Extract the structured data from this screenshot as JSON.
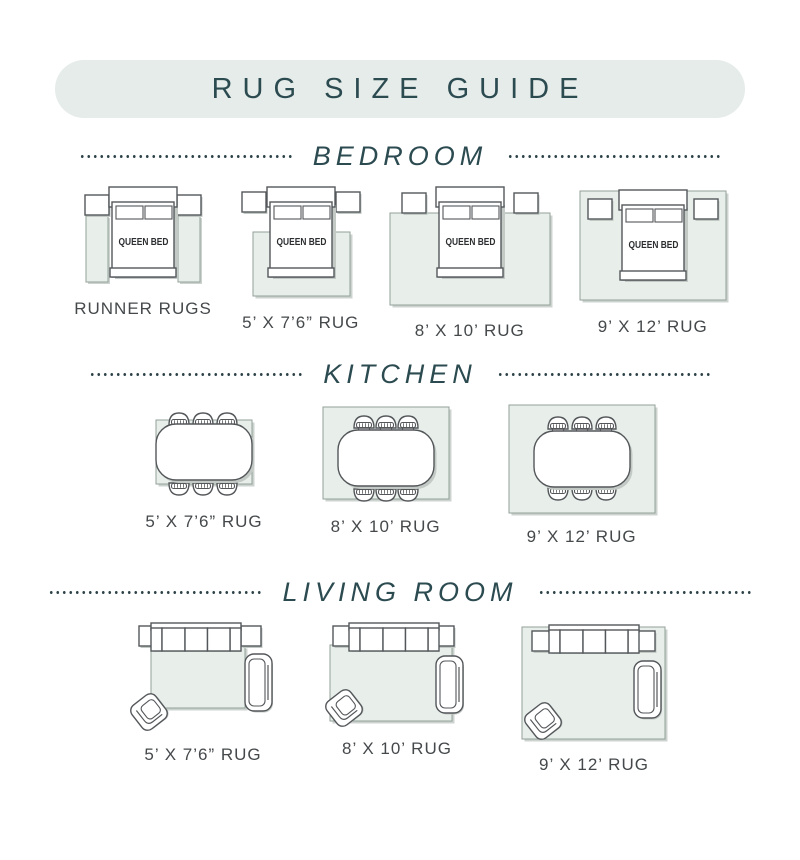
{
  "title": "RUG SIZE GUIDE",
  "bed_label": "QUEEN BED",
  "sections": [
    {
      "heading": "BEDROOM",
      "items": [
        {
          "label": "RUNNER RUGS"
        },
        {
          "label": "5’ X 7’6” RUG"
        },
        {
          "label": "8’ X 10’ RUG"
        },
        {
          "label": "9’ X 12’ RUG"
        }
      ]
    },
    {
      "heading": "KITCHEN",
      "items": [
        {
          "label": "5’ X 7’6” RUG"
        },
        {
          "label": "8’ X 10’ RUG"
        },
        {
          "label": "9’ X 12’ RUG"
        }
      ]
    },
    {
      "heading": "LIVING ROOM",
      "items": [
        {
          "label": "5’ X 7’6” RUG"
        },
        {
          "label": "8’ X 10’ RUG"
        },
        {
          "label": "9’ X 12’ RUG"
        }
      ]
    }
  ],
  "colors": {
    "accent_teal": "#2c4b51",
    "banner_bg": "#e5ece9",
    "rug_fill": "#e8efeb",
    "rug_border": "#93a09a",
    "furniture_outline": "#54575a",
    "label_gray": "#45494b",
    "shadow_gray": "#c3cac6"
  }
}
